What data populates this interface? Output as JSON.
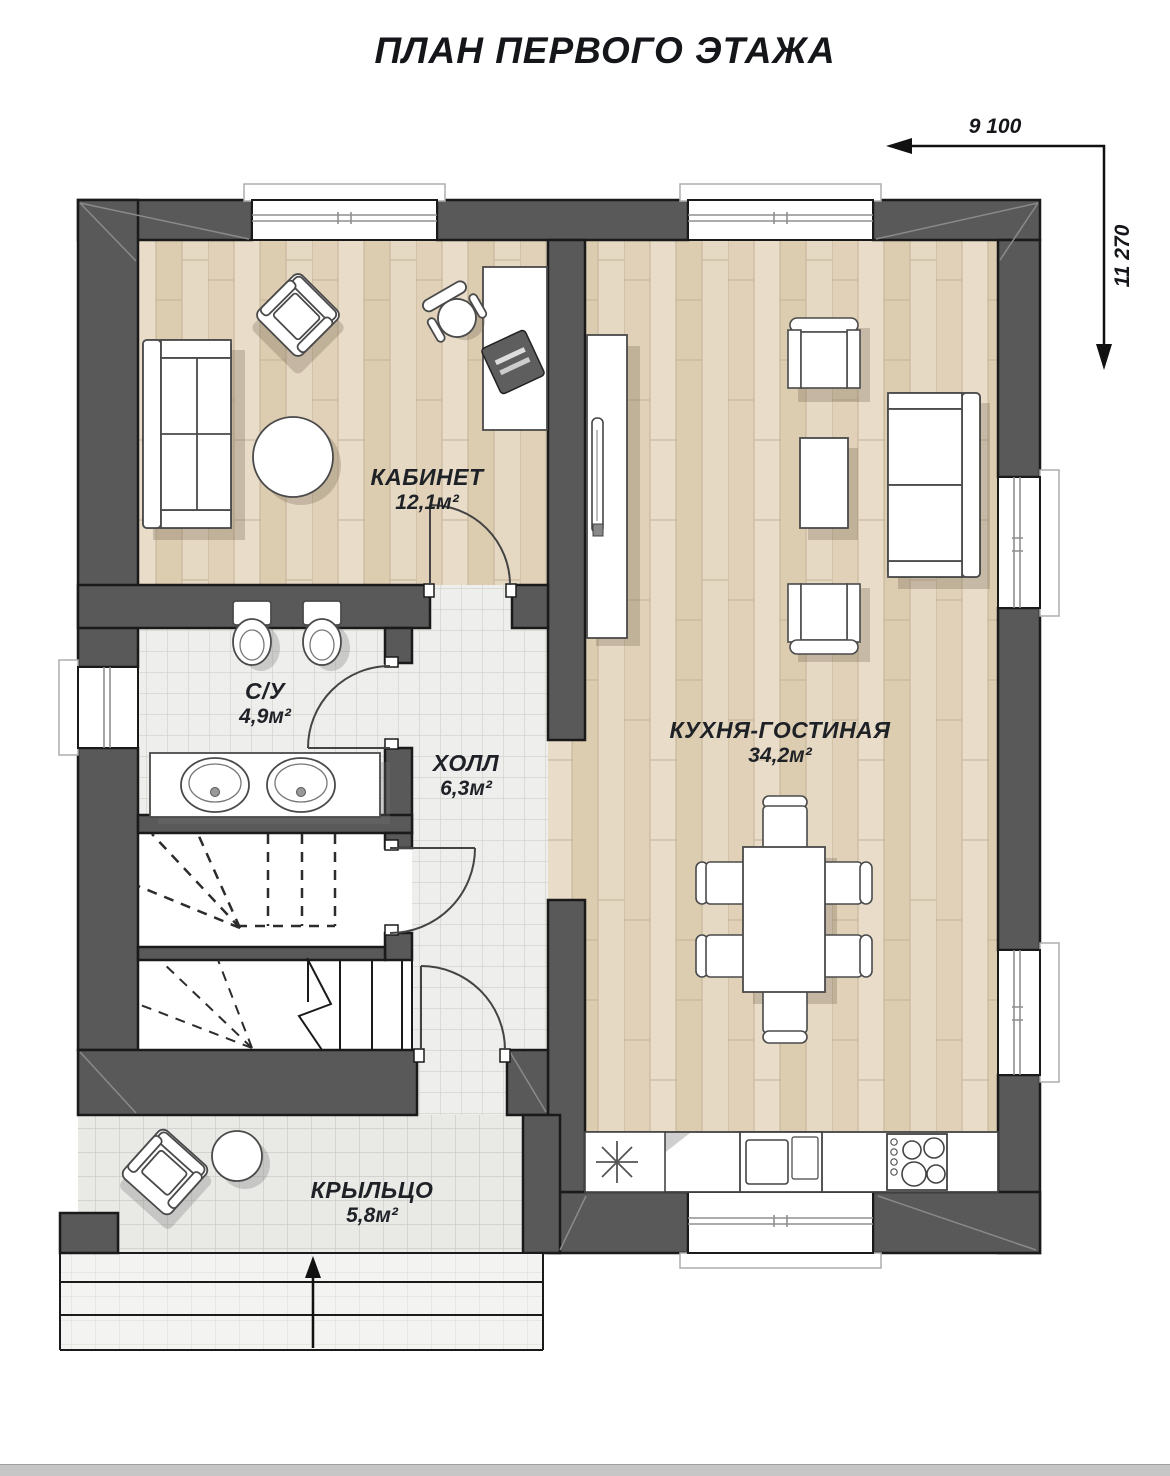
{
  "title": "ПЛАН ПЕРВОГО ЭТАЖА",
  "dimensions": {
    "horizontal": "9 100",
    "vertical": "11 270"
  },
  "rooms": {
    "office": {
      "name": "КАБИНЕТ",
      "area": "12,1м²"
    },
    "bathroom": {
      "name": "С/У",
      "area": "4,9м²"
    },
    "hall": {
      "name": "ХОЛЛ",
      "area": "6,3м²"
    },
    "kitchen_living": {
      "name": "КУХНЯ-ГОСТИНАЯ",
      "area": "34,2м²"
    },
    "porch": {
      "name": "КРЫЛЬЦО",
      "area": "5,8м²"
    }
  },
  "colors": {
    "wall": "#595959",
    "outline": "#1a1a1a",
    "wood_floor": "#e4d7c2",
    "tile_floor": "#eeeeec",
    "porch_tile": "#eaeae7",
    "label_text": "#1e2126"
  }
}
